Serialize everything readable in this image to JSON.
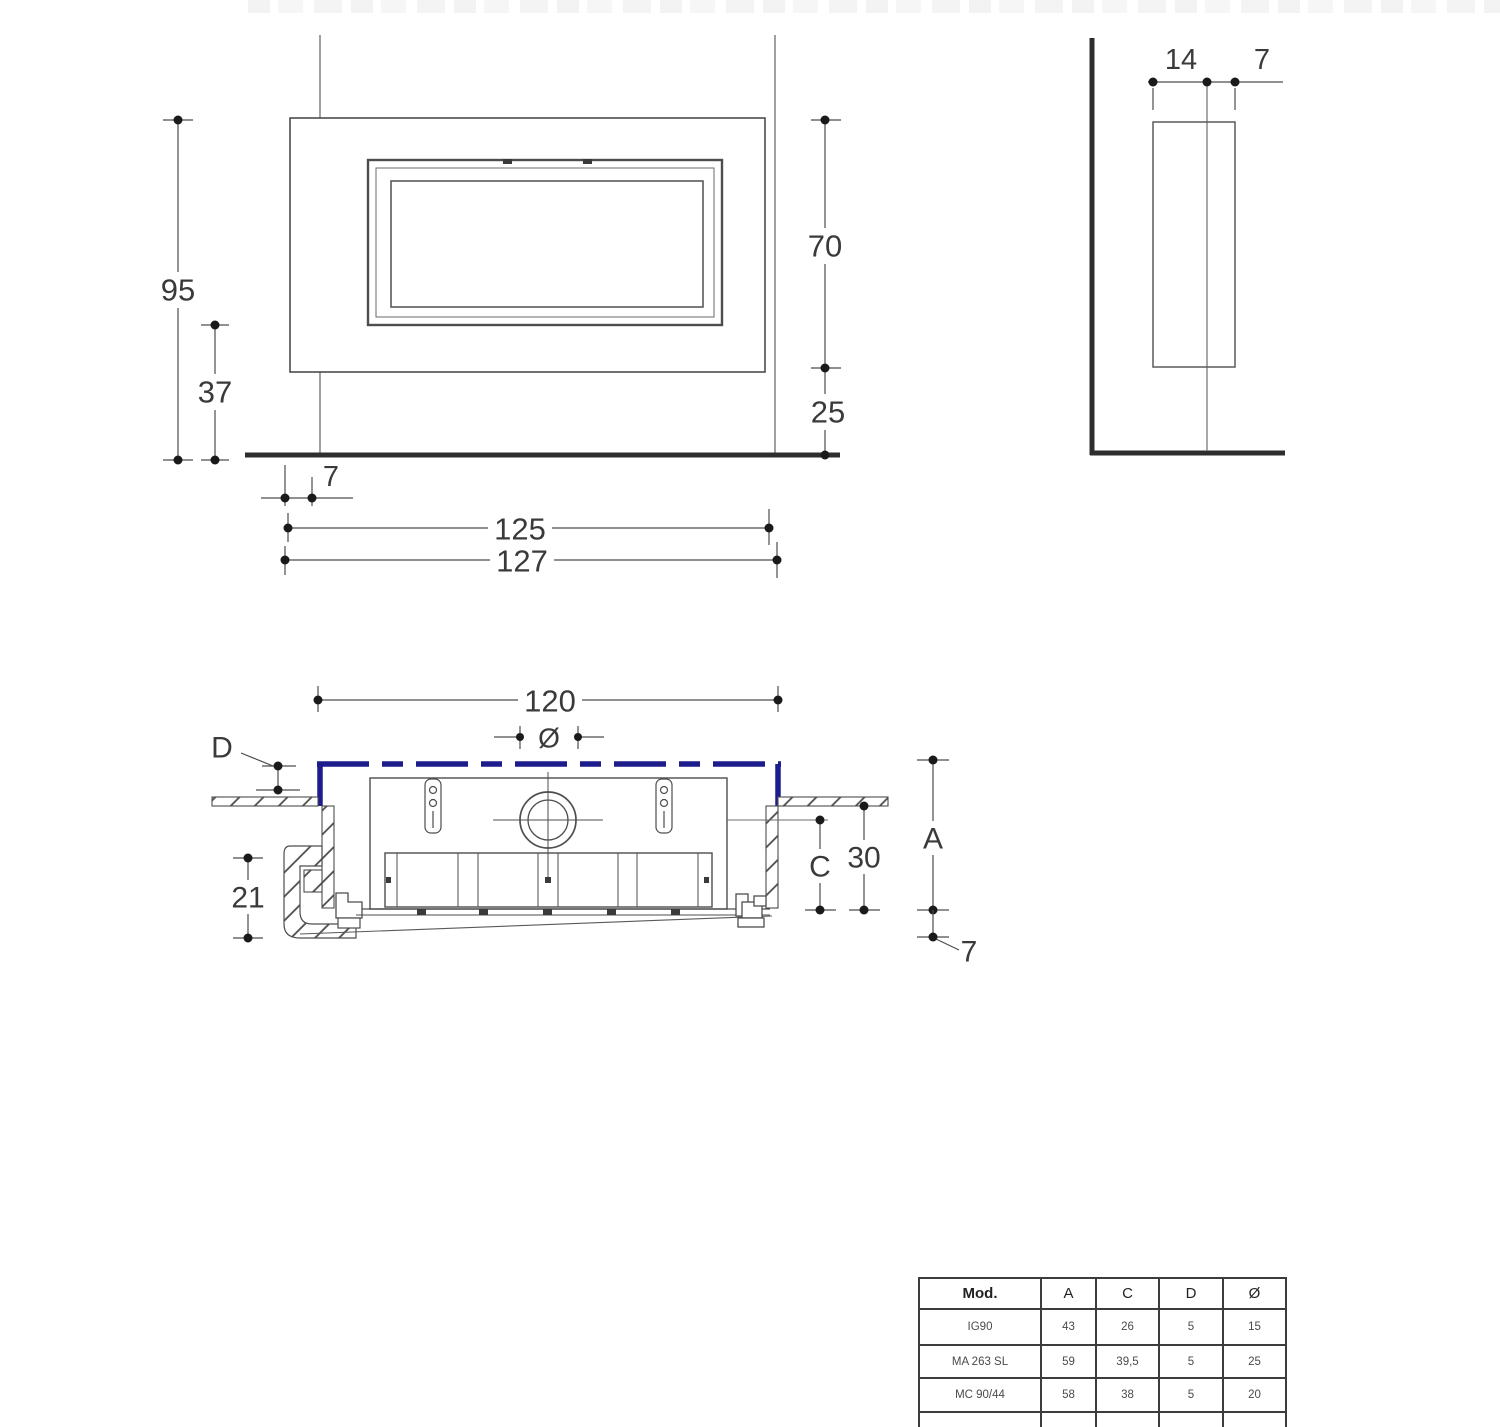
{
  "colors": {
    "accent_blue": "#1c1c8c",
    "line": "#4d4d4d",
    "dark": "#2e2e2e"
  },
  "front_view": {
    "dim_total_height": "95",
    "dim_lower_height": "37",
    "dim_window_height": "70",
    "dim_bottom_height": "25",
    "dim_side_offset": "7",
    "dim_inner_width": "125",
    "dim_outer_width": "127"
  },
  "side_view": {
    "dim_depth_back": "14",
    "dim_depth_front": "7"
  },
  "plan_view": {
    "dim_width": "120",
    "dim_diameter_symbol": "Ø",
    "label_d": "D",
    "dim_left_depth": "21",
    "label_c": "C",
    "dim_depth_30": "30",
    "label_a": "A",
    "dim_bottom_offset": "7"
  },
  "spec_table": {
    "headers": [
      "Mod.",
      "A",
      "C",
      "D",
      "Ø"
    ],
    "rows": [
      [
        "IG90",
        "43",
        "26",
        "5",
        "15"
      ],
      [
        "MA 263 SL",
        "59",
        "39,5",
        "5",
        "25"
      ],
      [
        "MC 90/44",
        "58",
        "38",
        "5",
        "20"
      ]
    ]
  }
}
